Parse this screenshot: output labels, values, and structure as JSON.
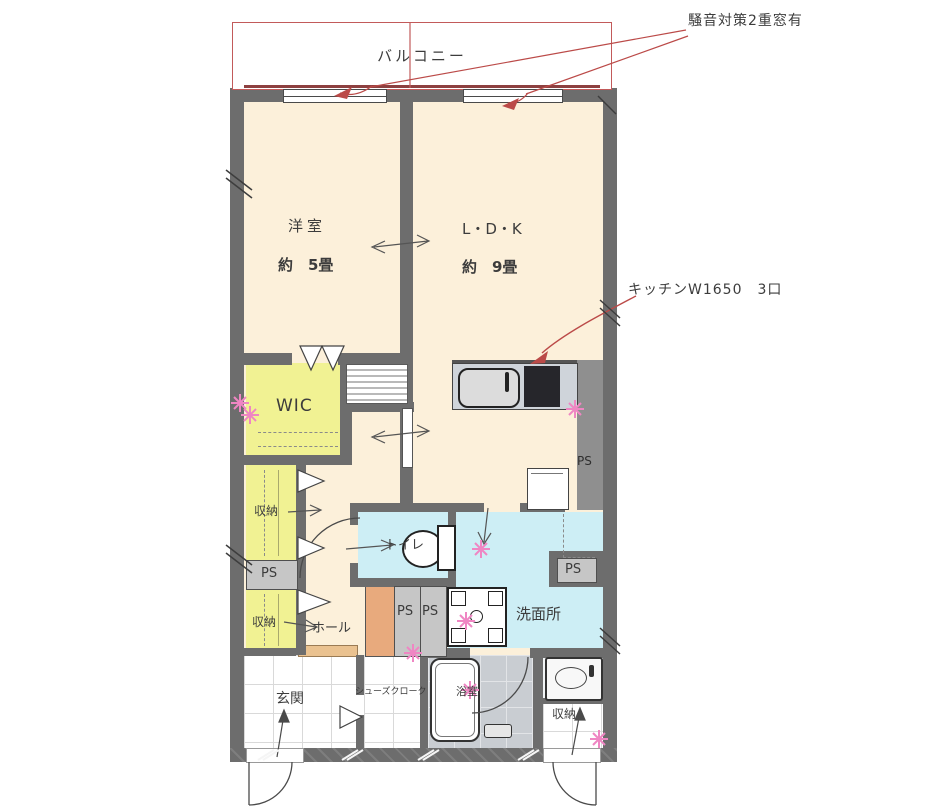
{
  "balcony": {
    "label": "バルコニー"
  },
  "notes": {
    "double_window": "騒音対策2重窓有",
    "kitchen": "キッチンW1650　3口"
  },
  "rooms": {
    "western": {
      "name": "洋室",
      "size": "約　5畳"
    },
    "ldk": {
      "name": "L・D・K",
      "size": "約　9畳"
    },
    "wic": {
      "name": "WIC"
    },
    "storage_mid": {
      "name": "収納"
    },
    "storage_low": {
      "name": "収納"
    },
    "storage_entry": {
      "name": "収納"
    },
    "toilet": {
      "name": "トイレ"
    },
    "washroom": {
      "name": "洗面所"
    },
    "hall": {
      "name": "ホール"
    },
    "entrance": {
      "name": "玄関"
    },
    "shoe_closet": {
      "name": "シューズクローク"
    },
    "bathroom": {
      "name": "浴室"
    }
  },
  "labels": {
    "ps": "PS"
  },
  "colors": {
    "wall": "#6d6d6d",
    "room_cream": "#fcf0da",
    "closet_yellow": "#f1f293",
    "wet_blue": "#cdeef5",
    "annotation_red": "#bb4a48",
    "star_pink": "#ef86c3",
    "wood_orange": "#e8aa7d"
  }
}
